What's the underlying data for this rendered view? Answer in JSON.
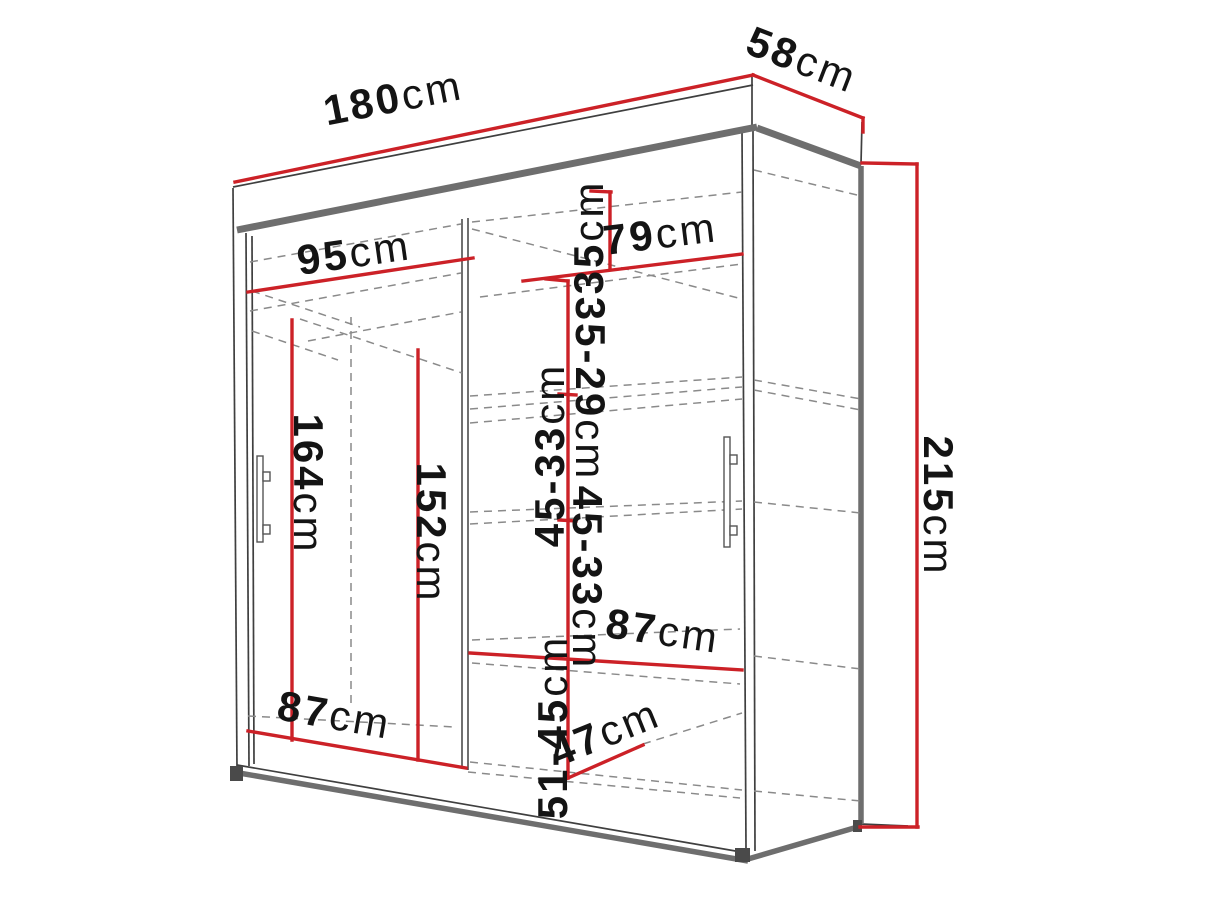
{
  "diagram": {
    "subject": "wardrobe-dimension-drawing",
    "colors": {
      "dimension_line": "#cc2127",
      "outline_thin": "#3f3f3f",
      "outline_thick": "#6e6e6e",
      "hidden_edge": "#8a8a8a",
      "label_text": "#141414",
      "background": "#ffffff"
    },
    "labels": [
      {
        "name": "overall-width",
        "value": "180",
        "unit": "cm"
      },
      {
        "name": "overall-depth",
        "value": "58",
        "unit": "cm"
      },
      {
        "name": "overall-height",
        "value": "215",
        "unit": "cm"
      },
      {
        "name": "left-top-width",
        "value": "95",
        "unit": "cm"
      },
      {
        "name": "right-top-width",
        "value": "79",
        "unit": "cm"
      },
      {
        "name": "top-shelf-gap",
        "value": "35",
        "unit": "cm"
      },
      {
        "name": "upper-shelf-gap",
        "value": "35-29",
        "unit": "cm"
      },
      {
        "name": "middle-shelf-gap-a",
        "value": "45-33",
        "unit": "cm"
      },
      {
        "name": "middle-shelf-gap-b",
        "value": "45-33",
        "unit": "cm"
      },
      {
        "name": "left-hanging-height",
        "value": "164",
        "unit": "cm"
      },
      {
        "name": "inner-hanging-height",
        "value": "152",
        "unit": "cm"
      },
      {
        "name": "left-bottom-width",
        "value": "87",
        "unit": "cm"
      },
      {
        "name": "right-shelf-width",
        "value": "87",
        "unit": "cm"
      },
      {
        "name": "bottom-shelf-gap",
        "value": "51-45",
        "unit": "cm"
      },
      {
        "name": "interior-depth",
        "value": "47",
        "unit": "cm"
      }
    ]
  }
}
